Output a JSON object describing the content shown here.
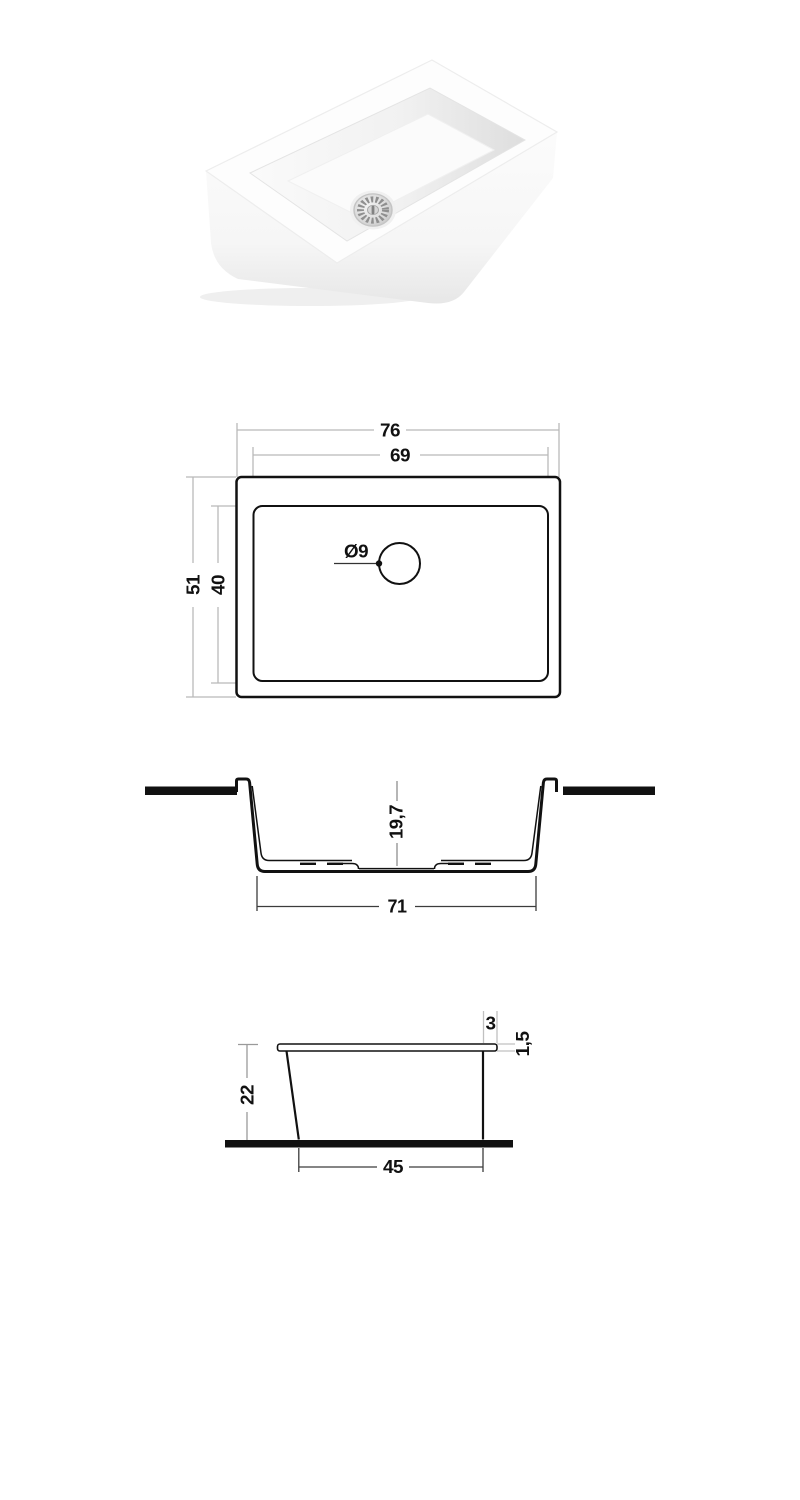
{
  "colors": {
    "drawing_line": "#111111",
    "dimension_line_light": "#b9b9b9",
    "dimension_line_mid": "#8f8f8f",
    "dimension_line_dark": "#3c3c3c",
    "countertop_fill": "#111111"
  },
  "top_view": {
    "outer_width": "76",
    "inner_width": "69",
    "outer_depth": "51",
    "inner_depth": "40",
    "drain_diameter": "Ø9"
  },
  "section_view": {
    "basin_depth": "19,7",
    "bottom_width": "71"
  },
  "side_view": {
    "rim_overhang": "3",
    "rim_thickness": "1,5",
    "height": "22",
    "base_width": "45"
  }
}
